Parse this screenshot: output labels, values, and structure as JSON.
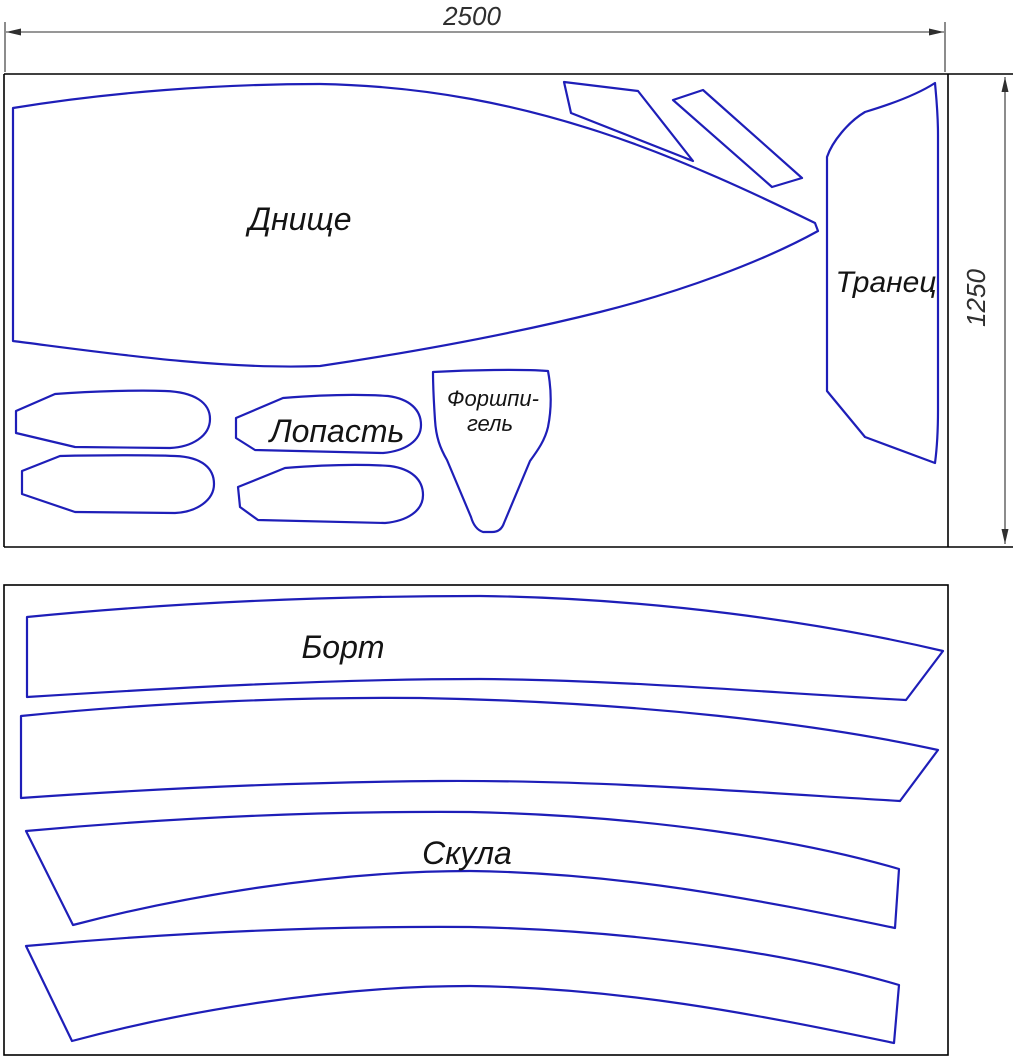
{
  "page": {
    "background": "#ffffff"
  },
  "colors": {
    "part_outline": "#1e1eb8",
    "frame": "#000000",
    "dimension": "#2f2f2f",
    "label_text": "#141414"
  },
  "dimensions": {
    "sheet_width_mm": "2500",
    "sheet_height_mm": "1250"
  },
  "labels": {
    "bottom_panel": "Днище",
    "transom": "Транец",
    "blade": "Лопасть",
    "forepeak_line1": "Форшпи-",
    "forepeak_line2": "гель",
    "side_panel": "Борт",
    "chine": "Скула"
  }
}
